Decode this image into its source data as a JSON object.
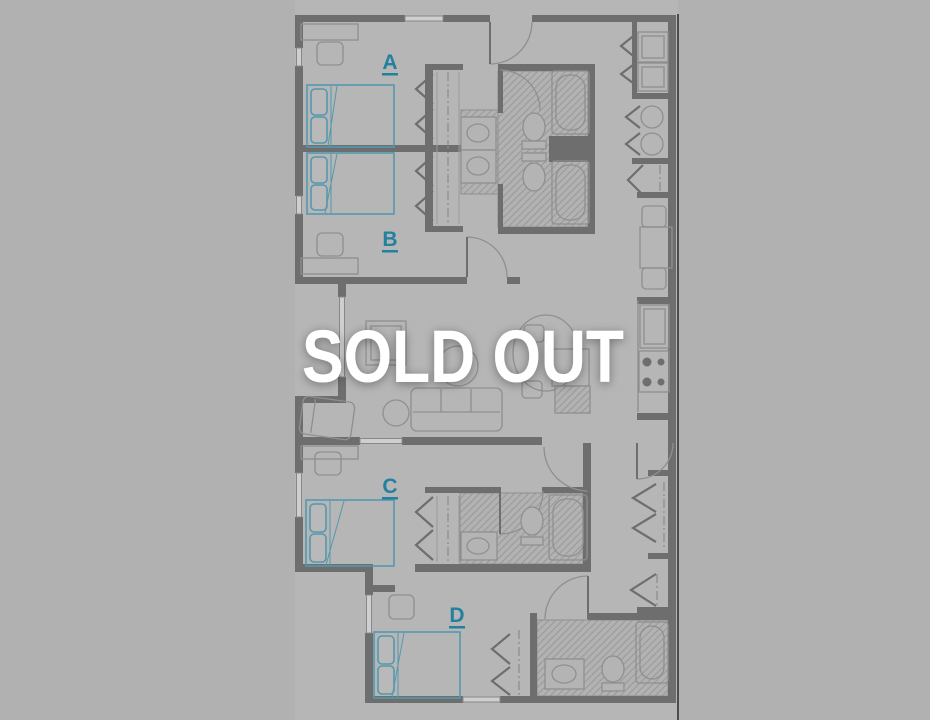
{
  "overlay": {
    "text": "SOLD OUT"
  },
  "floor_plan": {
    "rooms": [
      {
        "id": "room-a",
        "label": "A"
      },
      {
        "id": "room-b",
        "label": "B"
      },
      {
        "id": "room-c",
        "label": "C"
      },
      {
        "id": "room-d",
        "label": "D"
      }
    ]
  },
  "colors": {
    "background": "#b1b1b1",
    "plan_background": "#b6b6b6",
    "wall": "#6e6e6e",
    "furniture_line": "#8f8f8f",
    "accent_teal_label": "#23809f",
    "bed_teal": "#5498ae",
    "sold_out_text": "#ffffff"
  }
}
